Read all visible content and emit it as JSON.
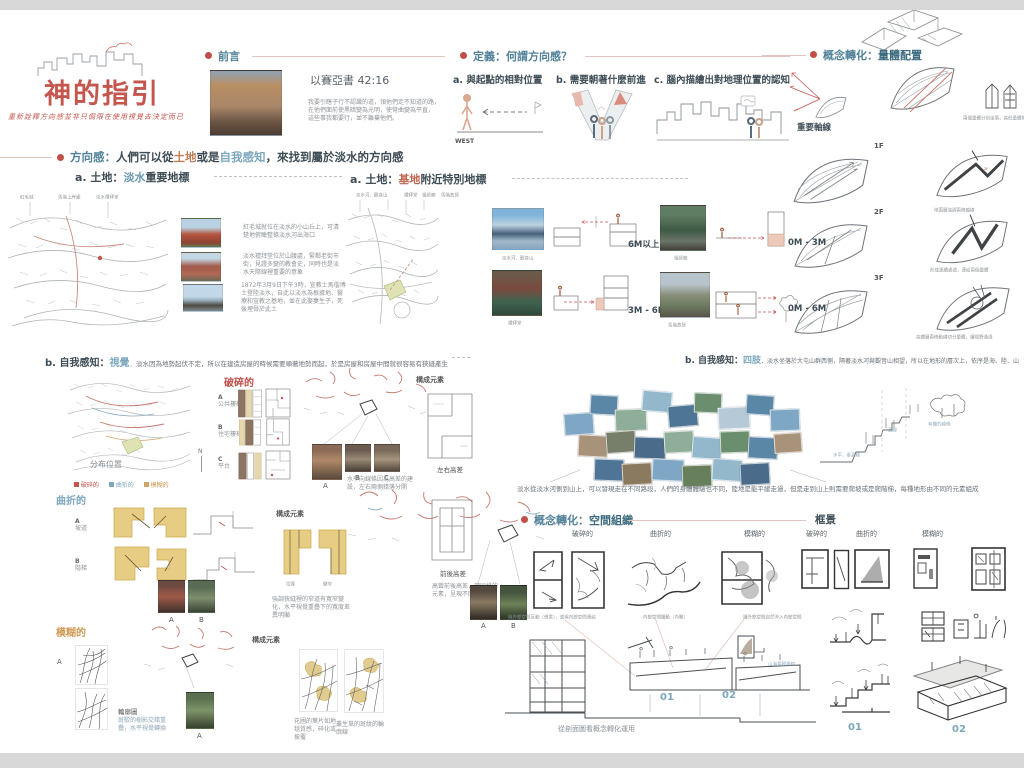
{
  "title_block": {
    "title": "神的指引",
    "subtitle": "重新詮釋方向感並非只侷限在使用視覺去決定而已"
  },
  "foreword": {
    "label": "前言",
    "verse_ref": "以賽亞書 42:16",
    "verse_line1": "我要引瞎子行不認識的道，領他們走不知道的路，",
    "verse_line2": "在他們面前使黑暗變為光明，使彎曲變為平直，",
    "verse_line3": "這些事我都要行，並不離棄他們。"
  },
  "definition": {
    "label": "定義：何謂方向感？",
    "item_a": "a. 與起點的相對位置",
    "item_b": "b. 需要朝著什麼前進",
    "item_c": "c. 腦內描繪出對地理位置的認知",
    "west": "WEST"
  },
  "concept_volume": {
    "prefix": "概念轉化：",
    "bold": "量體配置",
    "axis_caption": "重要軸線",
    "tower_caption": "兩個量體分別坐落，高低量體相互呼應",
    "floors": [
      {
        "tag": "1F",
        "caption": "地面層強調兩條軸線"
      },
      {
        "tag": "2F",
        "caption": "形成連續通道，連結兩個量體"
      },
      {
        "tag": "3F",
        "caption": "高樓層兩條動線切分量體，讓視野通透"
      }
    ]
  },
  "direction": {
    "label": "方向感：",
    "t1": "人們可以從",
    "hl_land": "土地",
    "t2": "或是",
    "hl_self": "自我感知",
    "t3": "，來找到屬於淡水的方向感"
  },
  "land_a": {
    "prefix": "a. 土地：",
    "hl": "淡水",
    "rest": "重要地標",
    "map_labels": [
      "紅毛城",
      "馬偕上岸處",
      "淡水禮拜堂"
    ],
    "captions": [
      "紅毛城就位在淡水的小山丘上，可清楚地俯瞰整條淡水河出海口",
      "淡水禮拜堂位於山腰處，緊鄰老街市街，見證多變的教會史，同時也是淡水天際線裡重要的意象",
      "1872年3月9日下午3時，宣教士馬偕博士登陸淡水，自此以淡水為根據地、醫療和宣教之基地，並在此娶妻生子，死後埋骨於此土"
    ]
  },
  "land_b": {
    "prefix": "a. 土地：",
    "hl": "基地",
    "rest": "附近特別地標",
    "map_labels": [
      "淡水河、觀音山",
      "禮拜堂",
      "祖師廟",
      "馬偕故居"
    ],
    "rows": [
      {
        "caption": "淡水河、觀音山",
        "distance": "6M以上"
      },
      {
        "caption": "禮拜堂",
        "distance": "3M - 6M"
      },
      {
        "caption": "祖師廟",
        "distance": "0M - 3M"
      },
      {
        "caption": "馬偕故居",
        "distance": "0M - 6M"
      }
    ]
  },
  "self_visual": {
    "prefix": "b. 自我感知：",
    "hl": "視覺",
    "desc": "．淡水因為地勢起伏不定，所以在建造房屋的時候需要順著地勢而起，於是房屋和房屋中間就很容易有狹縫產生",
    "map_caption": "分布位置",
    "compass": "N",
    "legend": [
      {
        "label": "破碎的"
      },
      {
        "label": "曲折的"
      },
      {
        "label": "模糊的"
      }
    ]
  },
  "fragmented": {
    "label": "破碎的",
    "rows": [
      {
        "tag": "A",
        "name": "公共樓梯"
      },
      {
        "tag": "B",
        "name": "住宅樓梯"
      },
      {
        "tag": "C",
        "name": "平台"
      }
    ],
    "photos": [
      "A",
      "B",
      "C"
    ],
    "element_label": "構成元素",
    "d1_caption": "左右高差",
    "d1_note": "水平向線條因為高差的建設，左右兩側錯落分開",
    "d2_caption": "前後高差",
    "d2_note": "高聳前後高差，讓同樣的元素，呈現不同大小"
  },
  "winding": {
    "label": "曲折的",
    "rows": [
      {
        "tag": "A",
        "name": "坡道"
      },
      {
        "tag": "B",
        "name": "階梯"
      }
    ],
    "photos": [
      "A",
      "B"
    ],
    "photos2": [
      "A",
      "B"
    ],
    "element_label": "構成元素",
    "d_captions": [
      "拉寬",
      "變窄"
    ],
    "note": "強調狹縫裡的窄道有寬窄變化，水平視覺重疊下的寬度差異明顯"
  },
  "blurred": {
    "label": "模糊的",
    "tag": "A",
    "pattern_caption": "輪廓圖",
    "pattern_note": "斑駁的樹影交錯重疊，水平視覺轉換",
    "photo_tag": "A",
    "element_label": "構成元素",
    "notes": [
      "花圃的葉片如地毯質感，碎化或披覆",
      "叢生草的斑紋的輪廓線"
    ]
  },
  "self_limbs": {
    "prefix": "b. 自我感知：",
    "hl": "四肢",
    "desc": "．淡水坐落於大屯山群西側，隔著淡水河與觀音山相望，所以在地形的層次上，依序是海、陸、山",
    "sketch_labels": [
      "水平、垂直線",
      "直線",
      "有機的線條"
    ],
    "caption": "淡水從淡水河側到山上，可以發現走在不同路段，人們的身體體驗也不同，陸地是能平緩走過，但是走到山上則需要爬坡或是爬階梯，每種地形由不同的元素組成"
  },
  "concept_space": {
    "prefix": "概念轉化：",
    "bold": "空間組織",
    "categories": [
      "破碎的",
      "曲折的",
      "模糊的"
    ],
    "captions": [
      "與外部空間互動（借景），或與內部空間連結",
      "內部空間擾動（內聚）",
      "讓外部空間自然滲入內部空間"
    ],
    "section_caption": "從剖面圖看概念轉化運用",
    "detail_caption": "山海景觀視線",
    "marker_01": "01",
    "marker_02": "02"
  },
  "framing": {
    "label": "框景",
    "categories": [
      "破碎的",
      "曲折的",
      "模糊的"
    ],
    "marker_01": "01",
    "marker_02": "02"
  }
}
